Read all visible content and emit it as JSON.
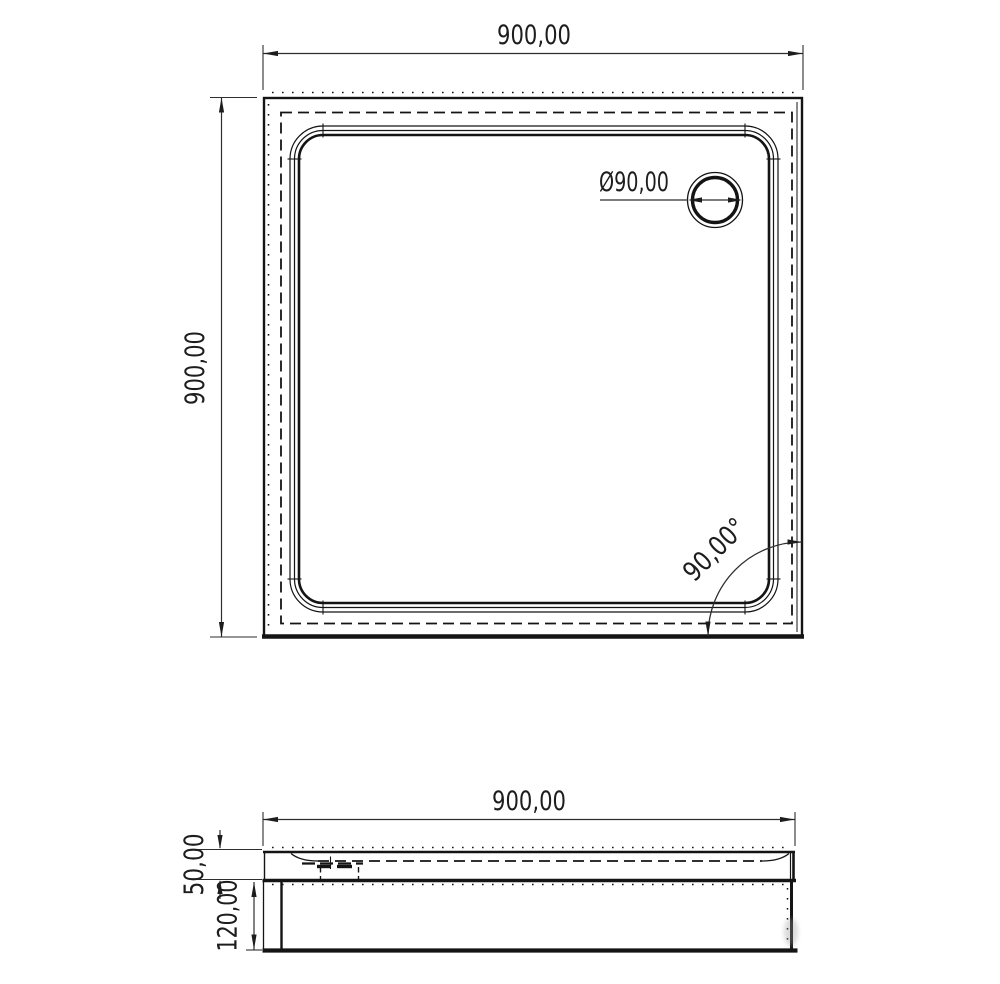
{
  "drawing": {
    "type": "technical-drawing-shower-tray",
    "views": {
      "top": {
        "width_dim_label": "900,00",
        "height_dim_label": "900,00",
        "drain_dim_label": "Ø90,00",
        "angle_dim_label": "90,00°"
      },
      "side": {
        "width_dim_label": "900,00",
        "upper_height_dim_label": "50,00",
        "lower_height_dim_label": "120,00"
      }
    },
    "colors": {
      "object_line": "#141414",
      "dimension_line": "#2e2e2e",
      "text": "#1d1d1d",
      "background": "#ffffff"
    }
  }
}
